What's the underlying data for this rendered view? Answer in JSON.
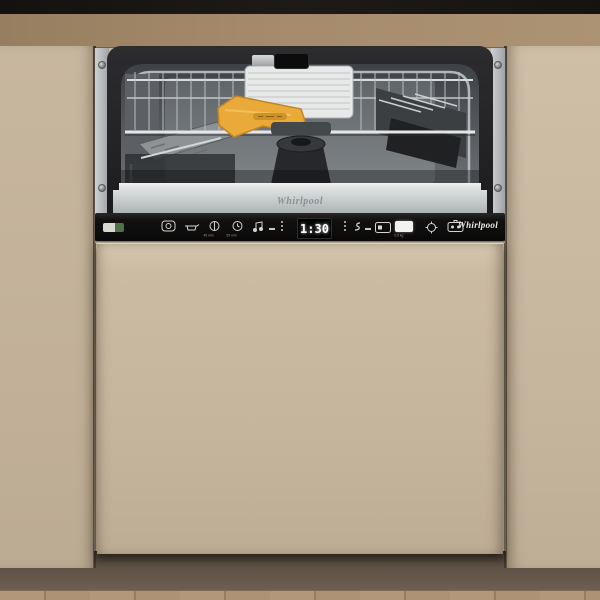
{
  "colors": {
    "cabinet": "#c6b59d",
    "door": "#c8b8a0",
    "wallBand": "#a58b6b",
    "topBar": "#1a1815",
    "panelBlack": "#0e0d0c",
    "plinth": "#63564a",
    "floorWood": "#b1977b",
    "steel": "#c3c7c9",
    "handleYellow": "#eaaa39",
    "displayText": "#ffffff"
  },
  "brand": "Whirlpool",
  "control_panel": {
    "display_value": "1:30",
    "logo": "Whirlpool",
    "micro_label_a": "45 min",
    "micro_label_b": "59 min",
    "micro_label_c": "0,5 kg",
    "icon_names": [
      "power-icon",
      "program-icon",
      "half-load-icon",
      "delay-icon",
      "option-icon",
      "salt-indicator-icon",
      "dispenser-icon",
      "start-button",
      "softener-icon",
      "child-lock-icon"
    ]
  },
  "inner_door": {
    "logo": "Whirlpool"
  },
  "interior": {
    "handle_color_name": "yellow-rack-handle"
  }
}
